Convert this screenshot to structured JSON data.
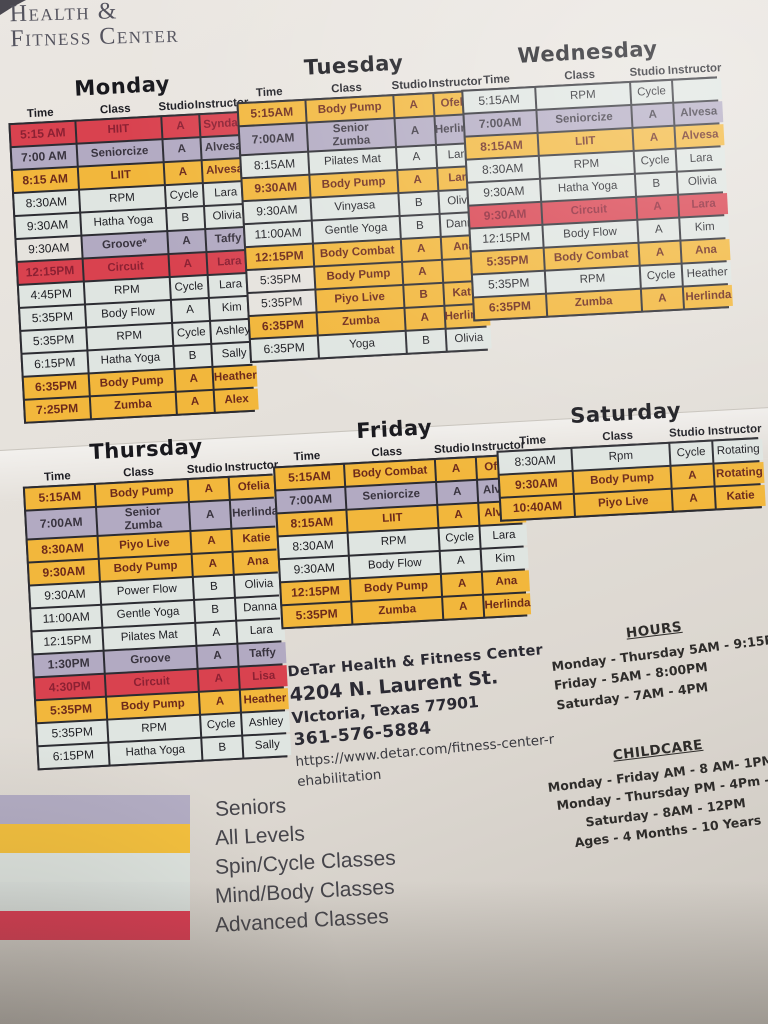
{
  "logo": {
    "line1": "Health &",
    "line2": "Fitness Center"
  },
  "columns": [
    "Time",
    "Class",
    "Studio",
    "Instructor"
  ],
  "colors": {
    "red": "#d9424f",
    "purple": "#b2aac2",
    "yellow": "#f2b73c",
    "light": "#dfe5e1",
    "plain_time": "#e6e3de"
  },
  "days": [
    {
      "name": "Monday",
      "rows": [
        {
          "time": "5:15 AM",
          "class": "HIIT",
          "studio": "A",
          "instructor": "Syndal",
          "cat": "red"
        },
        {
          "time": "7:00 AM",
          "class": "Seniorcize",
          "studio": "A",
          "instructor": "Alvesa",
          "cat": "purple"
        },
        {
          "time": "8:15 AM",
          "class": "LIIT",
          "studio": "A",
          "instructor": "Alvesa",
          "cat": "yellow"
        },
        {
          "time": "8:30AM",
          "class": "RPM",
          "studio": "Cycle",
          "instructor": "Lara",
          "cat": "light"
        },
        {
          "time": "9:30AM",
          "class": "Hatha Yoga",
          "studio": "B",
          "instructor": "Olivia",
          "cat": "light"
        },
        {
          "time": "9:30AM",
          "class": "Groove*",
          "studio": "A",
          "instructor": "Taffy",
          "cat": "purple",
          "tp": true
        },
        {
          "time": "12:15PM",
          "class": "Circuit",
          "studio": "A",
          "instructor": "Lara",
          "cat": "red"
        },
        {
          "time": "4:45PM",
          "class": "RPM",
          "studio": "Cycle",
          "instructor": "Lara",
          "cat": "light"
        },
        {
          "time": "5:35PM",
          "class": "Body Flow",
          "studio": "A",
          "instructor": "Kim",
          "cat": "light"
        },
        {
          "time": "5:35PM",
          "class": "RPM",
          "studio": "Cycle",
          "instructor": "Ashley",
          "cat": "light"
        },
        {
          "time": "6:15PM",
          "class": "Hatha Yoga",
          "studio": "B",
          "instructor": "Sally",
          "cat": "light"
        },
        {
          "time": "6:35PM",
          "class": "Body Pump",
          "studio": "A",
          "instructor": "Heather",
          "cat": "yellow"
        },
        {
          "time": "7:25PM",
          "class": "Zumba",
          "studio": "A",
          "instructor": "Alex",
          "cat": "yellow"
        }
      ]
    },
    {
      "name": "Tuesday",
      "rows": [
        {
          "time": "5:15AM",
          "class": "Body Pump",
          "studio": "A",
          "instructor": "Ofelia",
          "cat": "yellow"
        },
        {
          "time": "7:00AM",
          "class": "Senior\nZumba",
          "studio": "A",
          "instructor": "Herlinda",
          "cat": "purple"
        },
        {
          "time": "8:15AM",
          "class": "Pilates Mat",
          "studio": "A",
          "instructor": "Lara",
          "cat": "light"
        },
        {
          "time": "9:30AM",
          "class": "Body Pump",
          "studio": "A",
          "instructor": "Lara",
          "cat": "yellow"
        },
        {
          "time": "9:30AM",
          "class": "Vinyasa",
          "studio": "B",
          "instructor": "Olivia",
          "cat": "light"
        },
        {
          "time": "11:00AM",
          "class": "Gentle Yoga",
          "studio": "B",
          "instructor": "Danna",
          "cat": "light"
        },
        {
          "time": "12:15PM",
          "class": "Body Combat",
          "studio": "A",
          "instructor": "Ana",
          "cat": "yellow"
        },
        {
          "time": "5:35PM",
          "class": "Body Pump",
          "studio": "A",
          "instructor": "",
          "cat": "yellow",
          "tp": true
        },
        {
          "time": "5:35PM",
          "class": "Piyo Live",
          "studio": "B",
          "instructor": "Katie",
          "cat": "yellow",
          "tp": true
        },
        {
          "time": "6:35PM",
          "class": "Zumba",
          "studio": "A",
          "instructor": "Herlinda",
          "cat": "yellow"
        },
        {
          "time": "6:35PM",
          "class": "Yoga",
          "studio": "B",
          "instructor": "Olivia",
          "cat": "light"
        }
      ]
    },
    {
      "name": "Wednesday",
      "rows": [
        {
          "time": "5:15AM",
          "class": "RPM",
          "studio": "Cycle",
          "instructor": "",
          "cat": "light"
        },
        {
          "time": "7:00AM",
          "class": "Seniorcize",
          "studio": "A",
          "instructor": "Alvesa",
          "cat": "purple"
        },
        {
          "time": "8:15AM",
          "class": "LIIT",
          "studio": "A",
          "instructor": "Alvesa",
          "cat": "yellow"
        },
        {
          "time": "8:30AM",
          "class": "RPM",
          "studio": "Cycle",
          "instructor": "Lara",
          "cat": "light"
        },
        {
          "time": "9:30AM",
          "class": "Hatha Yoga",
          "studio": "B",
          "instructor": "Olivia",
          "cat": "light"
        },
        {
          "time": "9:30AM",
          "class": "Circuit",
          "studio": "A",
          "instructor": "Lara",
          "cat": "red"
        },
        {
          "time": "12:15PM",
          "class": "Body Flow",
          "studio": "A",
          "instructor": "Kim",
          "cat": "light"
        },
        {
          "time": "5:35PM",
          "class": "Body Combat",
          "studio": "A",
          "instructor": "Ana",
          "cat": "yellow"
        },
        {
          "time": "5:35PM",
          "class": "RPM",
          "studio": "Cycle",
          "instructor": "Heather",
          "cat": "light"
        },
        {
          "time": "6:35PM",
          "class": "Zumba",
          "studio": "A",
          "instructor": "Herlinda",
          "cat": "yellow"
        }
      ]
    },
    {
      "name": "Thursday",
      "rows": [
        {
          "time": "5:15AM",
          "class": "Body Pump",
          "studio": "A",
          "instructor": "Ofelia",
          "cat": "yellow"
        },
        {
          "time": "7:00AM",
          "class": "Senior\nZumba",
          "studio": "A",
          "instructor": "Herlinda",
          "cat": "purple"
        },
        {
          "time": "8:30AM",
          "class": "Piyo Live",
          "studio": "A",
          "instructor": "Katie",
          "cat": "yellow"
        },
        {
          "time": "9:30AM",
          "class": "Body Pump",
          "studio": "A",
          "instructor": "Ana",
          "cat": "yellow"
        },
        {
          "time": "9:30AM",
          "class": "Power Flow",
          "studio": "B",
          "instructor": "Olivia",
          "cat": "light"
        },
        {
          "time": "11:00AM",
          "class": "Gentle Yoga",
          "studio": "B",
          "instructor": "Danna",
          "cat": "light"
        },
        {
          "time": "12:15PM",
          "class": "Pilates Mat",
          "studio": "A",
          "instructor": "Lara",
          "cat": "light"
        },
        {
          "time": "1:30PM",
          "class": "Groove",
          "studio": "A",
          "instructor": "Taffy",
          "cat": "purple"
        },
        {
          "time": "4:30PM",
          "class": "Circuit",
          "studio": "A",
          "instructor": "Lisa",
          "cat": "red"
        },
        {
          "time": "5:35PM",
          "class": "Body Pump",
          "studio": "A",
          "instructor": "Heather",
          "cat": "yellow"
        },
        {
          "time": "5:35PM",
          "class": "RPM",
          "studio": "Cycle",
          "instructor": "Ashley",
          "cat": "light"
        },
        {
          "time": "6:15PM",
          "class": "Hatha Yoga",
          "studio": "B",
          "instructor": "Sally",
          "cat": "light"
        }
      ]
    },
    {
      "name": "Friday",
      "rows": [
        {
          "time": "5:15AM",
          "class": "Body Combat",
          "studio": "A",
          "instructor": "Ofelia",
          "cat": "yellow"
        },
        {
          "time": "7:00AM",
          "class": "Seniorcize",
          "studio": "A",
          "instructor": "Alvesa",
          "cat": "purple"
        },
        {
          "time": "8:15AM",
          "class": "LIIT",
          "studio": "A",
          "instructor": "Alvesa",
          "cat": "yellow"
        },
        {
          "time": "8:30AM",
          "class": "RPM",
          "studio": "Cycle",
          "instructor": "Lara",
          "cat": "light"
        },
        {
          "time": "9:30AM",
          "class": "Body Flow",
          "studio": "A",
          "instructor": "Kim",
          "cat": "light"
        },
        {
          "time": "12:15PM",
          "class": "Body Pump",
          "studio": "A",
          "instructor": "Ana",
          "cat": "yellow"
        },
        {
          "time": "5:35PM",
          "class": "Zumba",
          "studio": "A",
          "instructor": "Herlinda",
          "cat": "yellow"
        }
      ]
    },
    {
      "name": "Saturday",
      "rows": [
        {
          "time": "8:30AM",
          "class": "Rpm",
          "studio": "Cycle",
          "instructor": "Rotating",
          "cat": "light"
        },
        {
          "time": "9:30AM",
          "class": "Body Pump",
          "studio": "A",
          "instructor": "Rotating",
          "cat": "yellow"
        },
        {
          "time": "10:40AM",
          "class": "Piyo Live",
          "studio": "A",
          "instructor": "Katie",
          "cat": "yellow"
        }
      ]
    }
  ],
  "contact": {
    "name": "DeTar Health & Fitness Center",
    "address": "4204 N. Laurent St.",
    "city": "VIctoria, Texas 77901",
    "phone": "361-576-5884",
    "url_line1": "https://www.detar.com/fitness-center-r",
    "url_line2": "ehabilitation"
  },
  "hours": {
    "title": "HOURS",
    "lines": [
      "Monday - Thursday 5AM - 9:15PM",
      "Friday - 5AM - 8:00PM",
      "Saturday - 7AM - 4PM"
    ]
  },
  "childcare": {
    "title": "CHILDCARE",
    "lines": [
      "Monday - Friday AM - 8 AM- 1PM",
      "Monday - Thursday PM - 4Pm -",
      "Saturday - 8AM - 12PM",
      "Ages - 4 Months - 10 Years"
    ]
  },
  "legend": {
    "items": [
      {
        "label": "Seniors",
        "color": "#b3adc4"
      },
      {
        "label": "All Levels",
        "color": "#f5c13d"
      },
      {
        "label": "Spin/Cycle Classes",
        "color": "#dfe5e0"
      },
      {
        "label": "Mind/Body Classes",
        "color": "#dde3df"
      },
      {
        "label": "Advanced Classes",
        "color": "#e13b52"
      }
    ]
  }
}
